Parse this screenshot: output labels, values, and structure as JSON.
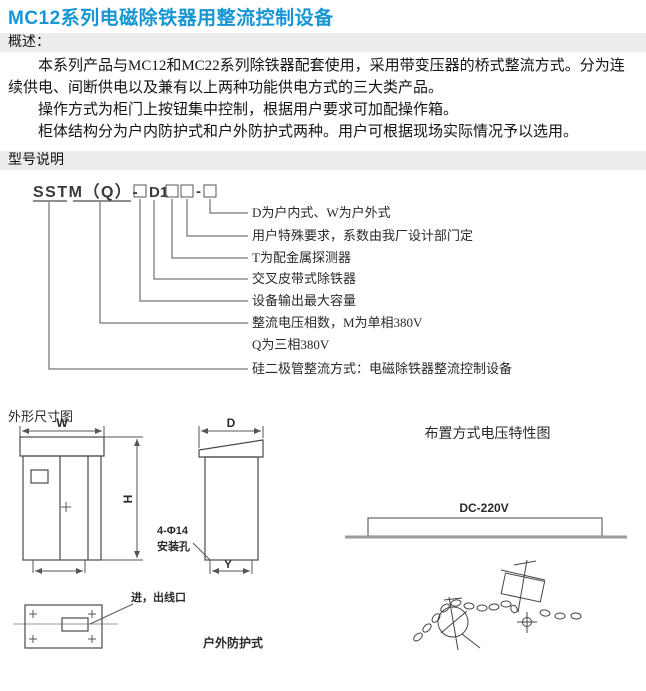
{
  "page": {
    "title": "MC12系列电磁除铁器用整流控制设备"
  },
  "overview": {
    "heading": "概述：",
    "paragraphs": [
      "本系列产品与MC12和MC22系列除铁器配套使用，采用带变压器的桥式整流方式。分为连续供电、间断供电以及兼有以上两种功能供电方式的三大类产品。",
      "操作方式为柜门上按钮集中控制，根据用户要求可加配操作箱。",
      "柜体结构分为户内防护式和户外防护式两种。用户可根据现场实际情况予以选用。"
    ]
  },
  "model": {
    "heading": "型号说明",
    "code": {
      "prefix": "SSTM（Q）-",
      "mid": "D1",
      "dash": "-"
    },
    "labels": [
      "D为户内式、W为户外式",
      "用户特殊要求，系数由我厂设计部门定",
      "T为配金属探测器",
      "交叉皮带式除铁器",
      "设备输出最大容量",
      "整流电压相数，M为单相380V",
      "Q为三相380V",
      "硅二极管整流方式：电磁除铁器整流控制设备"
    ]
  },
  "outline": {
    "heading": "外形尺寸图",
    "dim_w": "W",
    "dim_h": "H",
    "dim_d": "D",
    "dim_y": "Y",
    "hole_line1": "4-Φ14",
    "hole_line2": "安装孔",
    "outlet": "进，出线口",
    "outdoor": "户外防护式"
  },
  "layout": {
    "heading": "布置方式电压特性图",
    "voltage": "DC-220V"
  },
  "colors": {
    "title_blue": "#1796d4",
    "section_bar_bg": "#ececec",
    "drawing_line": "#555555",
    "ground_line": "#9b9b9b"
  }
}
